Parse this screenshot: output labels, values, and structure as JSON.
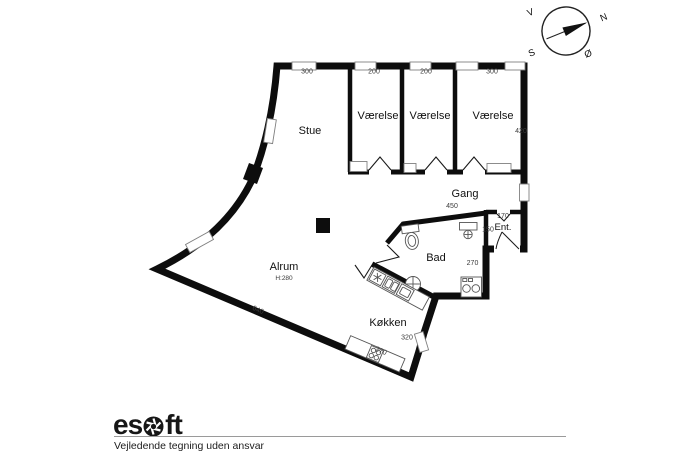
{
  "compass": {
    "west": "V",
    "north": "N",
    "south": "S",
    "east": "Ø"
  },
  "rooms": {
    "stue": {
      "label": "Stue",
      "width": "300"
    },
    "vaerelse1": {
      "label": "Værelse",
      "width": "200"
    },
    "vaerelse2": {
      "label": "Værelse",
      "width": "200"
    },
    "vaerelse3": {
      "label": "Værelse",
      "width": "300",
      "depth": "420"
    },
    "gang": {
      "label": "Gang",
      "width": "450"
    },
    "ent": {
      "label": "Ent.",
      "width": "170",
      "depth": "150"
    },
    "bad": {
      "label": "Bad",
      "depth": "270"
    },
    "alrum": {
      "label": "Alrum",
      "ceiling_height": "H:280"
    },
    "koekken": {
      "label": "Køkken",
      "side_wall": "320",
      "counter": "270"
    }
  },
  "outer": {
    "south_wall": "640"
  },
  "footer": {
    "brand": "esoft",
    "brand_prefix": "es",
    "brand_suffix": "ft",
    "disclaimer": "Vejledende tegning uden ansvar"
  },
  "icons": {
    "compass": "compass-rose-icon",
    "aperture": "camera-aperture-icon",
    "toilet": "toilet-icon",
    "washbasin": "washbasin-icon",
    "round_basin": "round-basin-icon",
    "washer_dryer": "washer-dryer-icon",
    "fridge": "fridge-asterisk-icon",
    "sink": "kitchen-sink-icon",
    "stove": "stove-burners-icon"
  },
  "colors": {
    "wall": "#0d0d0d",
    "window_stroke": "#808080",
    "fixture_stroke": "#555555",
    "rule": "#9a9a9a"
  }
}
